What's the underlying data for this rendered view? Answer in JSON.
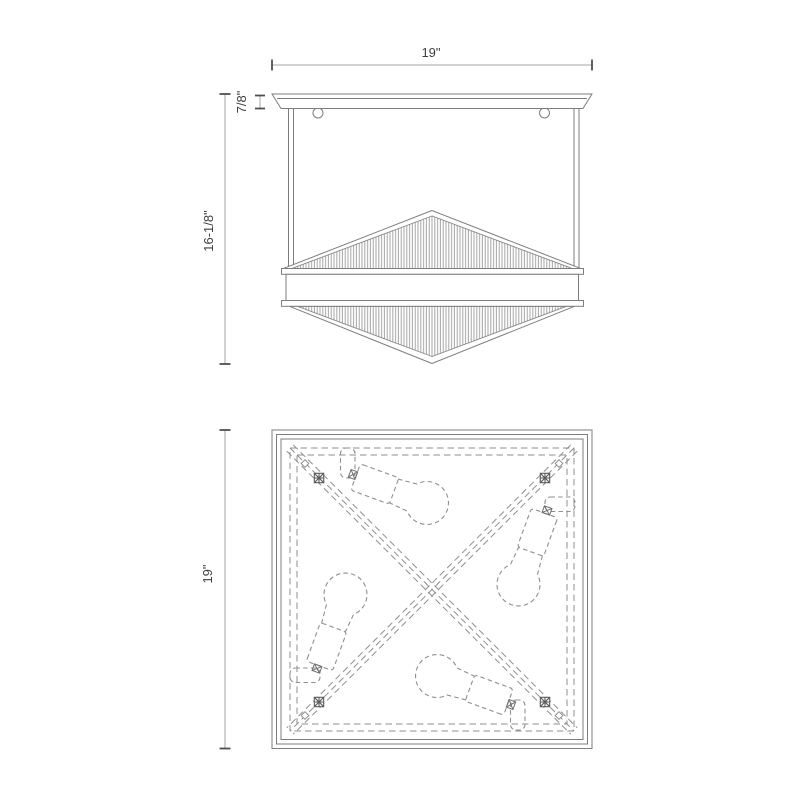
{
  "colors": {
    "line": "#7d7d7d",
    "dashed": "#8f8f8f",
    "hatch": "#9c9c9c",
    "dim_line": "#a6a6a6",
    "tick": "#4f4f4f",
    "text": "#3e3e3e",
    "background": "#ffffff",
    "bracket": "#5a5a5a"
  },
  "front_view": {
    "width_label": "19\"",
    "canopy_height_label": "7/8\"",
    "overall_height_label": "16-1/8\""
  },
  "bottom_view": {
    "width_label": "19\"",
    "bulb_count": 4
  }
}
